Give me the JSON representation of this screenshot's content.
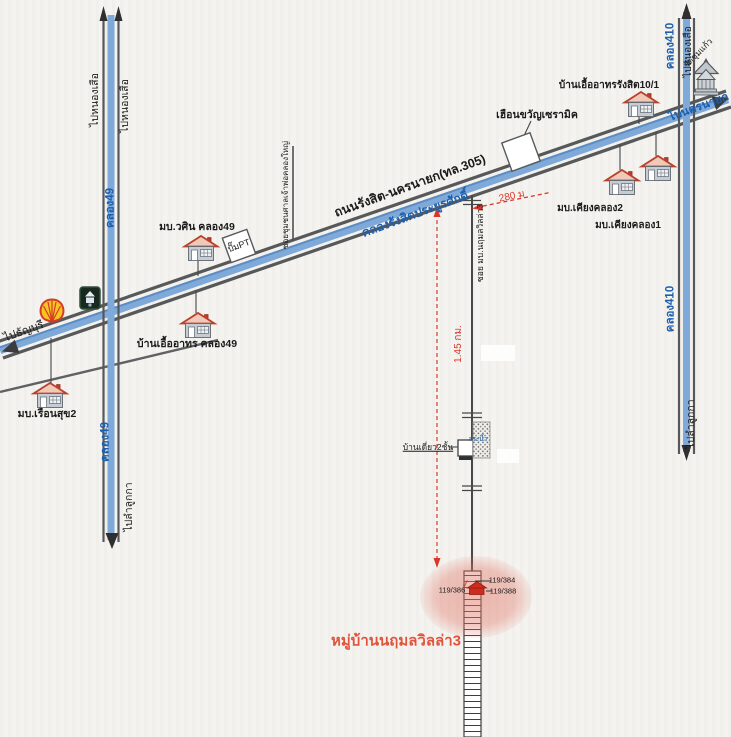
{
  "colors": {
    "road_gray": "#57585a",
    "canal_blue": "#7ea9d8",
    "blue_text": "#1d5fae",
    "measure_red": "#d9372a",
    "village_red": "#e0543c",
    "highlight_pink": "#e27869"
  },
  "highway": {
    "name": "ถนนรังสิต-นครนายก(ทล.305)",
    "canal_name": "คลองรังสิตประยูรศักดิ์",
    "to_thanyaburi": "ไปธัญบุรี",
    "to_nakhonnayok": "ไปนครนายก"
  },
  "canal49": {
    "name": "คลอง49",
    "name_lower": "คลอง49",
    "to_nong_suea_left": "ไปหนองเสือ",
    "to_nong_suea_right": "ไปหนองเสือ",
    "to_lam_luk_ka": "ไปลำลูกกา"
  },
  "canal410": {
    "name": "คลอง410",
    "name_lower": "คลอง410",
    "to_nong_suea": "ไปหนองเสือ",
    "to_lam_luk_ka": "ไปลำลูกกา"
  },
  "roads": {
    "soi_shrine": "ซอยชุมชนศาลเจ้าพ่อคลองใหญ่",
    "soi_village": "ซอย มบ.นฤมลวิลล่า3"
  },
  "measurements": {
    "to_soi": "280 ม",
    "soi_length": "1.45 กม."
  },
  "places": {
    "wasin": "มบ.วศิน คลอง49",
    "pt_station": "ปั๊มPT",
    "uaarthorn_k49": "บ้านเอื้ออาทร คลอง49",
    "ruensuk2": "มบ.เรือนสุข2",
    "ceramic_shop": "เฮือนขวัญเซรามิค",
    "uaarthorn_rangsit": "บ้านเอื้ออาทรรังสิต10/1",
    "kiang_khlong2": "มบ.เคียงคลอง2",
    "kiang_khlong1": "มบ.เคียงคลอง1",
    "temple": "วัดชุมแก้ว",
    "two_storey_house": "บ้านเดี่ยว2ชั้น",
    "pond": "สระน้ำ",
    "village_title": "หมู่บ้านนฤมลวิลล่า3"
  },
  "addresses": {
    "a384": "119/384",
    "a386": "119/386",
    "a388": "119/388"
  },
  "marks": {
    "check": "✓"
  }
}
